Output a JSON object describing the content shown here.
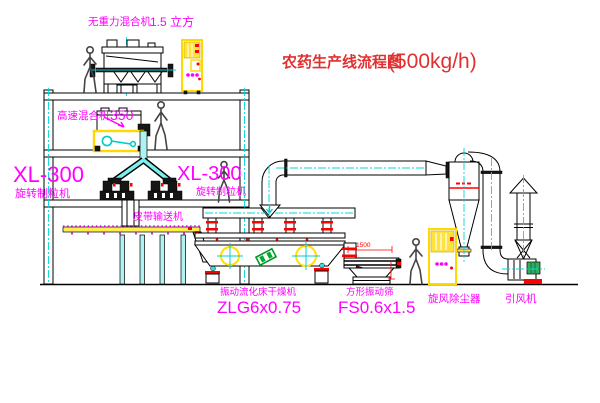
{
  "title": {
    "text": "农药生产线流程图",
    "capacity": "(500kg/h)"
  },
  "equipment_labels": {
    "gravity_free_mixer": {
      "name": "无重力混合机",
      "spec": "1.5 立方"
    },
    "high_speed_mixer": {
      "name": "高速混合机",
      "spec": "350"
    },
    "granulator_left": {
      "model": "XL-300",
      "name": "旋转制粒机"
    },
    "granulator_right": {
      "model": "XL-300",
      "name": "旋转制粒机"
    },
    "belt_conveyor": {
      "name": "皮带输送机"
    },
    "fluid_bed_dryer": {
      "name": "振动流化床干燥机",
      "model": "ZLG6x0.75"
    },
    "vibrating_screen": {
      "name": "方形振动筛",
      "model": "FS0.6x1.5"
    },
    "cyclone": {
      "name": "旋风除尘器"
    },
    "induced_draft_fan": {
      "name": "引风机"
    }
  },
  "dimensions": {
    "screen_length": "1500"
  },
  "colors": {
    "label_magenta": "#ff00ff",
    "title_red": "#e03030",
    "line_black": "#000000",
    "centerline_cyan": "#00d8d8",
    "equipment_yellow": "#ffd800",
    "flange_red": "#ff0000",
    "motor_green": "#2fae5e"
  }
}
